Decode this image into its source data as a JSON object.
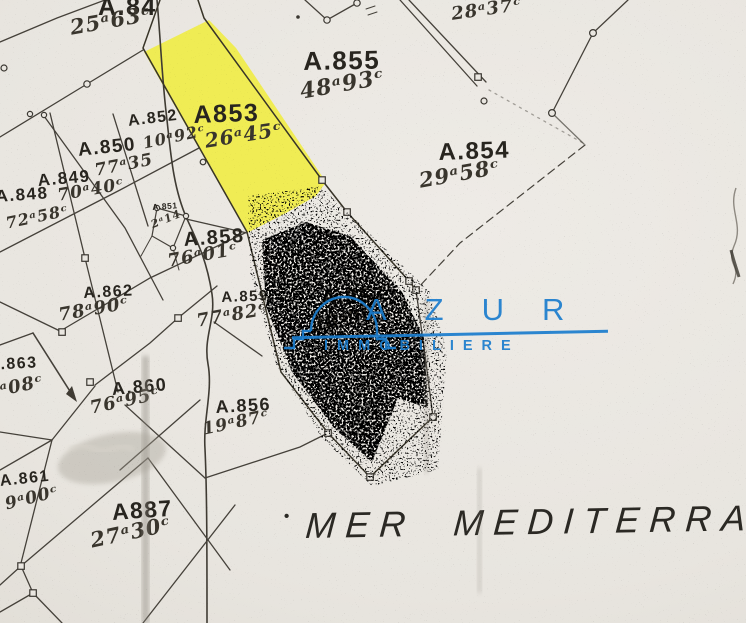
{
  "map": {
    "sea": {
      "label": "MER MEDITERRAN",
      "dot": "•"
    },
    "watermark": {
      "name": "AZUR",
      "subtitle": "IMMOBILIERE",
      "color": "#1b7dce"
    },
    "colors": {
      "highlight": "#f0ed34",
      "paper": "#eae7e1",
      "ink": "#45413a"
    },
    "parcels": [
      {
        "id": "A.84",
        "area": "25ᵃ63ᶜ"
      },
      {
        "id": "A.855",
        "area": "48ᵃ93ᶜ"
      },
      {
        "id": "A853",
        "area": "26ᵃ45ᶜ"
      },
      {
        "id": "A.854",
        "area": "29ᵃ58ᶜ"
      },
      {
        "id": "A.852",
        "area": "10ᵃ92ᶜ"
      },
      {
        "id": "A.850",
        "area": "77ᵃ35"
      },
      {
        "id": "A.849",
        "area": ""
      },
      {
        "id": "A.848",
        "area": "70ᵃ40ᶜ"
      },
      {
        "id": "A.851",
        "area": "2ᵃ14"
      },
      {
        "id": "A.858",
        "area": "76ᵃ01ᶜ"
      },
      {
        "id": "A.862",
        "area": "78ᵃ90ᶜ"
      },
      {
        "id": "A.859",
        "area": "77ᵃ82ᶜ"
      },
      {
        "id": "A.857",
        "area": "28ᵃ90"
      },
      {
        "id": "A.863",
        "area": "ᵃ08ᶜ"
      },
      {
        "id": "A.860",
        "area": "76ᵃ95ᶜ"
      },
      {
        "id": "A.856",
        "area": "19ᵃ87ᶜ"
      },
      {
        "id": "A.861",
        "area": "9ᵃ00ᶜ"
      },
      {
        "id": "A887",
        "area": "27ᵃ30ᶜ"
      }
    ],
    "loose_measurements": [
      {
        "value": "28ᵃ37ᶜ"
      },
      {
        "value": "72ᵃ58ᶜ"
      }
    ]
  }
}
